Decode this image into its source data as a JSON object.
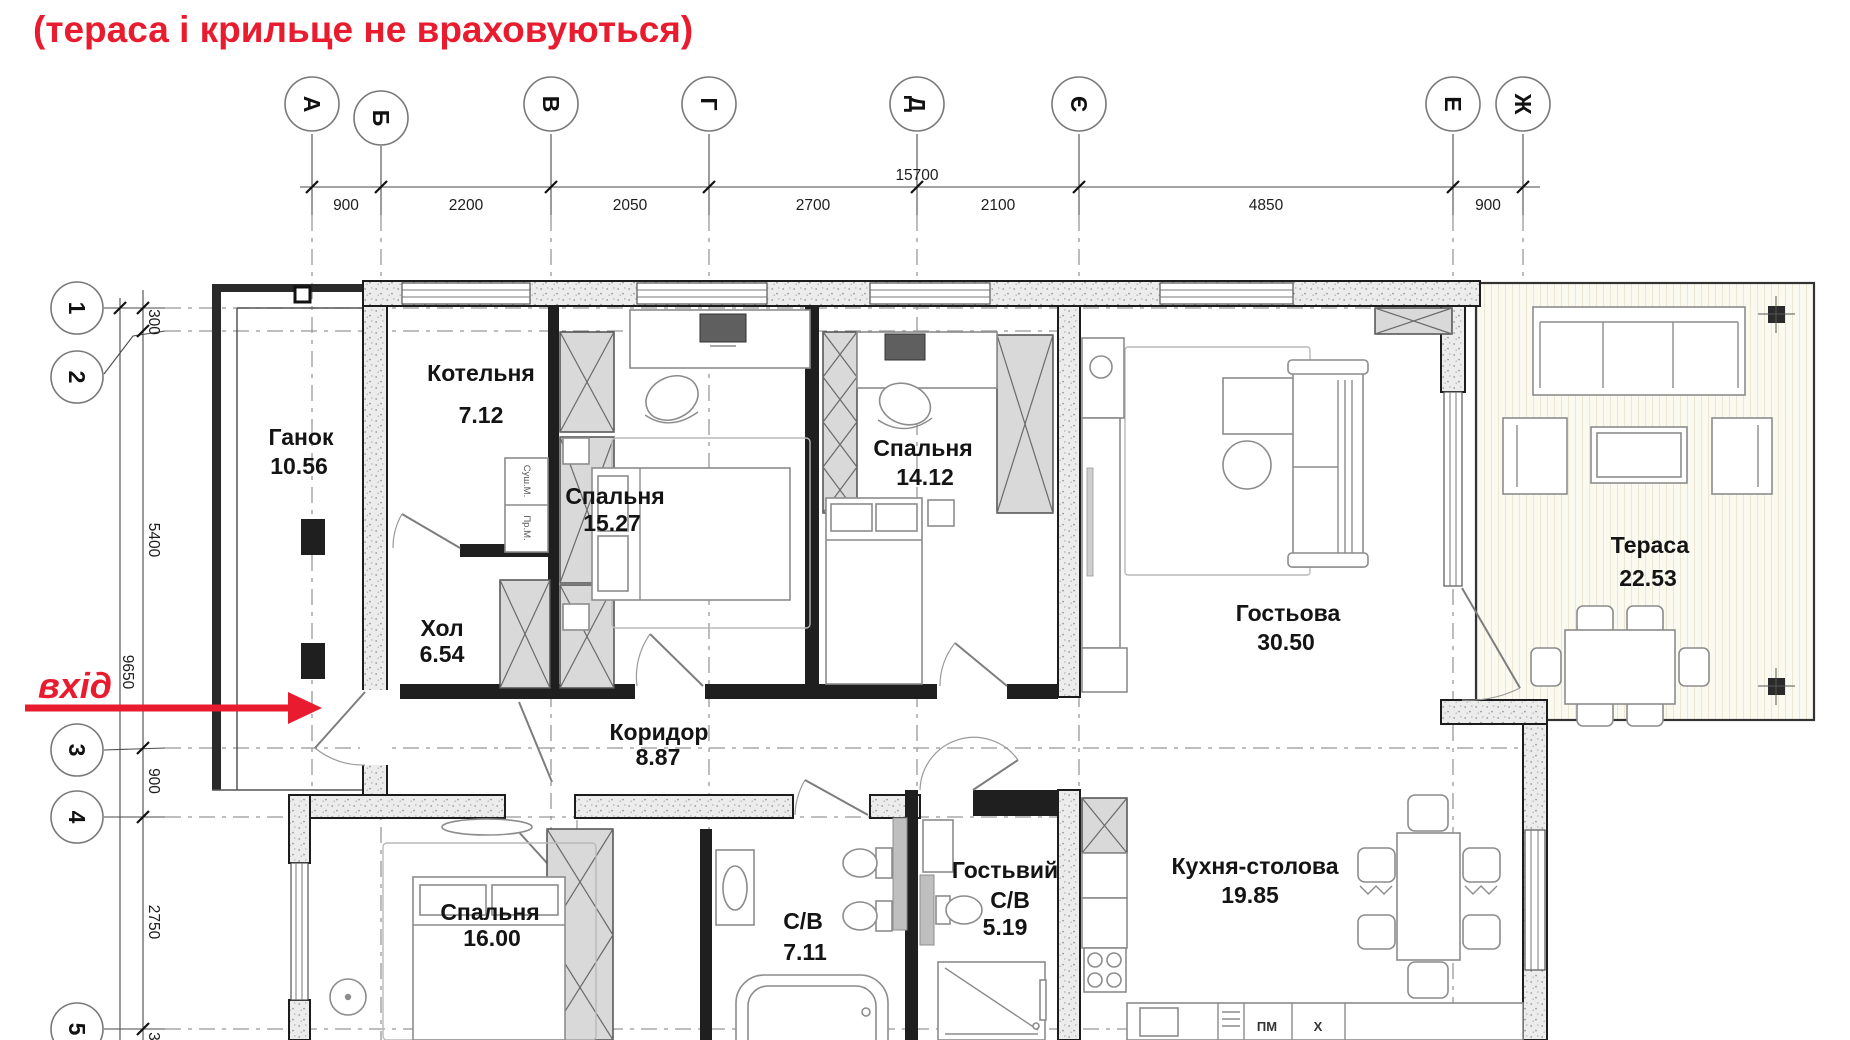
{
  "title": "(тераса і крильце не враховуються)",
  "entrance": {
    "label": "вхід"
  },
  "axes_top": [
    {
      "label": "А"
    },
    {
      "label": "Б"
    },
    {
      "label": "В"
    },
    {
      "label": "Г"
    },
    {
      "label": "Д"
    },
    {
      "label": "Є"
    },
    {
      "label": "Е"
    },
    {
      "label": "Ж"
    }
  ],
  "axes_left": [
    {
      "label": "1"
    },
    {
      "label": "2"
    },
    {
      "label": "3"
    },
    {
      "label": "4"
    },
    {
      "label": "5"
    }
  ],
  "dims_top": {
    "total": "15700",
    "segments": [
      "900",
      "2200",
      "2050",
      "2700",
      "2100",
      "4850",
      "900"
    ]
  },
  "dims_left": {
    "total": "9650",
    "segments": [
      "300",
      "5400",
      "900",
      "2750",
      "300"
    ]
  },
  "rooms": [
    {
      "name": "Ганок",
      "area": "10.56"
    },
    {
      "name": "Котельня",
      "area": "7.12"
    },
    {
      "name": "Спальня",
      "area": "15.27"
    },
    {
      "name": "Спальня",
      "area": "14.12"
    },
    {
      "name": "Хол",
      "area": "6.54"
    },
    {
      "name": "Коридор",
      "area": "8.87"
    },
    {
      "name": "Гостьова",
      "area": "30.50"
    },
    {
      "name": "Тераса",
      "area": "22.53"
    },
    {
      "name": "Спальня",
      "area": "16.00"
    },
    {
      "name": "С/В",
      "area": "7.11"
    },
    {
      "name": "Гостьвий С/В",
      "name_line1": "Гостьвий",
      "name_line2": "С/В",
      "area": "5.19"
    },
    {
      "name": "Кухня-столова",
      "area": "19.85"
    }
  ],
  "appliances": {
    "dryer": "Суш.М.",
    "washer": "Пр.М.",
    "dishwasher": "ПМ",
    "hob_mark": "Х"
  },
  "colors": {
    "accent_red": "#e81c2e",
    "wall_dark": "#1f1f1f",
    "wall_fill": "#ececec",
    "axis_dash": "#979797"
  }
}
